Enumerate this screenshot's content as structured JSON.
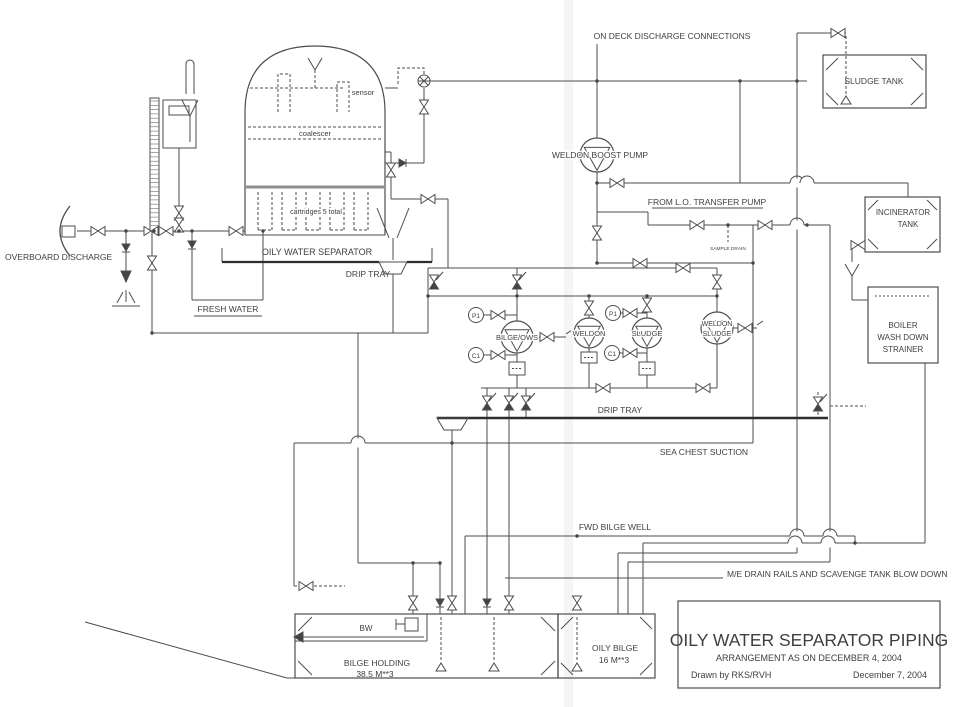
{
  "drawing": {
    "colors": {
      "background": "#ffffff",
      "line": "#4d4d4d",
      "text": "#3f3f3f"
    },
    "labels": {
      "on_deck": "ON DECK DISCHARGE CONNECTIONS",
      "sludge_tank": "SLUDGE TANK",
      "weldon_boost_pump": "WELDON BOOST PUMP",
      "from_lo_transfer": "FROM L.O. TRANSFER PUMP",
      "sample_drain": "SAMPLE DRAIN",
      "incinerator_line1": "INCINERATOR",
      "incinerator_line2": "TANK",
      "boiler_line1": "BOILER",
      "boiler_line2": "WASH DOWN",
      "boiler_line3": "STRAINER",
      "overboard_discharge": "OVERBOARD DISCHARGE",
      "fresh_water": "FRESH WATER",
      "sensor": "sensor",
      "coalescer": "coalescer",
      "cartridges": "cartridges 5 total",
      "oily_water_separator": "OILY WATER SEPARATOR",
      "drip_tray_left": "DRIP TRAY",
      "drip_tray_right": "DRIP TRAY",
      "pump_bilge_ows": "BILGE/OWS",
      "pump_weldon": "WELDON",
      "pump_sludge": "SLUDGE",
      "pump_weldon_sludge_line1": "WELDON",
      "pump_weldon_sludge_line2": "SLUDGE",
      "tag_p1": "P1",
      "tag_c1": "C1",
      "sea_chest_suction": "SEA CHEST SUCTION",
      "fwd_bilge_well": "FWD BILGE WELL",
      "me_drain_rails": "M/E DRAIN RAILS AND SCAVENGE TANK BLOW DOWN",
      "bw": "BW",
      "bilge_holding_line1": "BILGE HOLDING",
      "bilge_holding_line2": "38.5 M**3",
      "oily_bilge_line1": "OILY BILGE",
      "oily_bilge_line2": "16 M**3"
    },
    "title_block": {
      "title": "OILY WATER SEPARATOR PIPING",
      "subtitle": "ARRANGEMENT AS ON DECEMBER 4, 2004",
      "drawn_by": "Drawn by RKS/RVH",
      "date": "December 7, 2004"
    },
    "icons": {
      "valve-icon": "bowtie gate valve",
      "angle-valve-icon": "bowtie valve with diagonal actuator",
      "check-valve-icon": "filled triangle with seat bar",
      "motor-valve-icon": "circle with X blades",
      "pump-icon": "circle with inscribed triangle",
      "instrument-tag": "circled instrument label",
      "funnel-icon": "open drain funnel",
      "vent-icon": "Y shaped air vent",
      "pipe-crossover": "semicircular hop over crossing pipe",
      "junction-dot": "filled pipe junction",
      "sounding-end-icon": "open triangle at sounding pipe end"
    }
  }
}
